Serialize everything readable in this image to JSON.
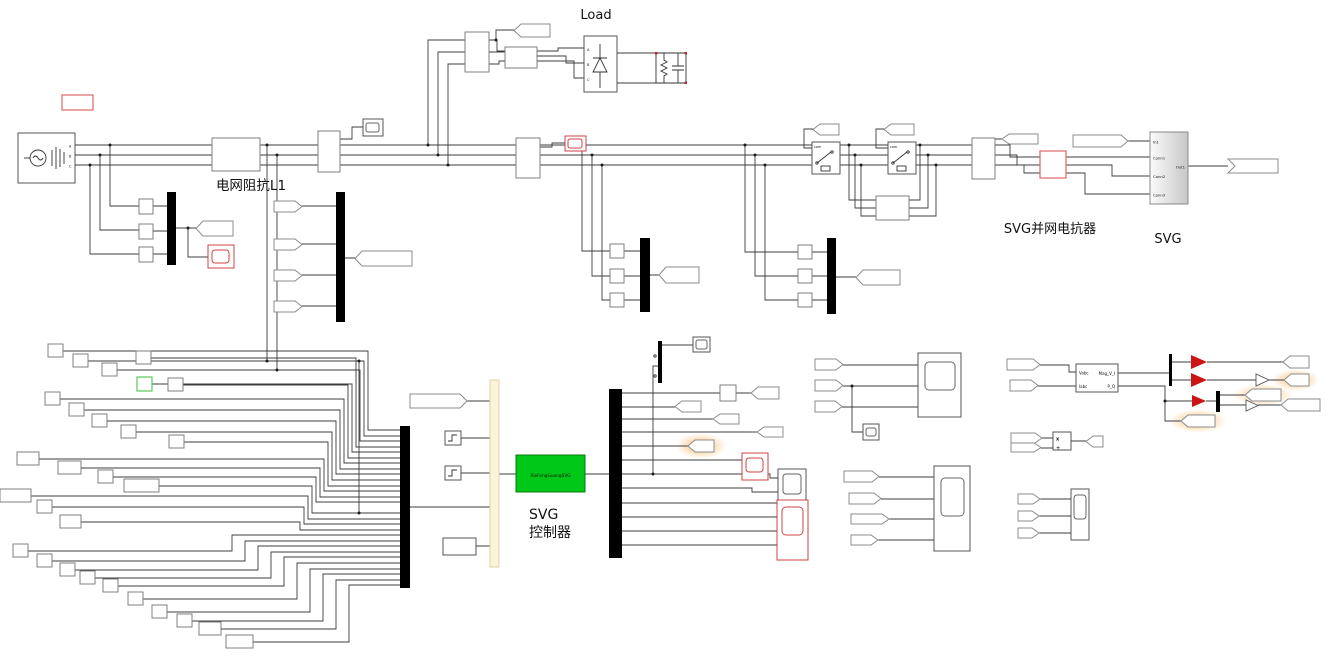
{
  "annotations": {
    "load": "Load",
    "grid_impedance": "电网阻抗L1",
    "svg_reactor": "SVG并网电抗器",
    "svg_subsystem": "SVG",
    "controller_line1": "SVG",
    "controller_line2": "控制器"
  },
  "blocks": {
    "controller": {
      "label": "XieFengGuangSVG"
    },
    "svg_subsystem_ports": {
      "in1": "In1",
      "conn1": "Conn1",
      "conn2": "Conn2",
      "conn3": "Conn3",
      "out1": "Out1"
    },
    "power_measurement_ports": {
      "in1": "Vabc",
      "in2": "Iabc",
      "out1": "Mag_V_I",
      "out2": "P_Q"
    },
    "breaker_label": "com",
    "rectifier_ports": {
      "a": "A",
      "b": "B",
      "c": "C"
    },
    "source_ports": {
      "a": "A",
      "b": "B",
      "c": "C"
    },
    "product_ports": {
      "multiply": "x",
      "divide": "÷"
    }
  },
  "colors": {
    "wire": "#3c3c3c",
    "block_border": "#7f7f7f",
    "mux_fill": "#000000",
    "annotation_red": "#e06666",
    "scope_red": "#cc4444",
    "controller_green": "#00c818",
    "controller_border": "#0b7a0b",
    "bus_cream": "#fbf4da",
    "gain_red": "#cc1414",
    "highlight_orange": "#f7a53c",
    "green_outline": "#55cc55"
  }
}
